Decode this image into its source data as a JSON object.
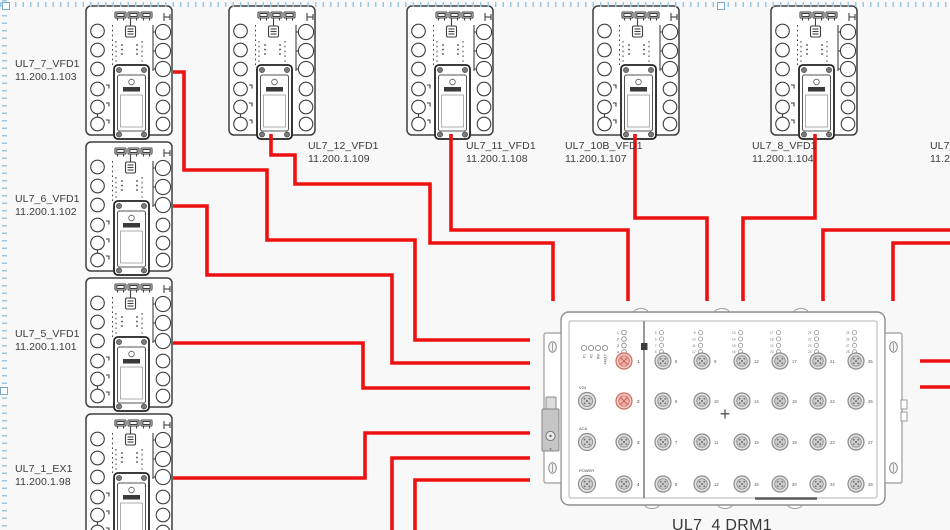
{
  "canvas": {
    "width": 950,
    "height": 530,
    "background": "#f8f8f8",
    "cable_color": "#ee1111",
    "outline_color": "#3f3f3f",
    "selection_color": "#9cc6e6"
  },
  "selection": {
    "handles": [
      {
        "x": 2,
        "y": 2
      },
      {
        "x": 717,
        "y": 2
      },
      {
        "x": 0,
        "y": 387
      }
    ]
  },
  "devices": [
    {
      "id": "UL7_7_VFD1",
      "label": "UL7_7_VFD1",
      "ip": "11.200.1.103",
      "x": 85,
      "y": 5,
      "label_x": 15,
      "label_y": 58
    },
    {
      "id": "UL7_6_VFD1",
      "label": "UL7_6_VFD1",
      "ip": "11.200.1.102",
      "x": 85,
      "y": 141,
      "label_x": 15,
      "label_y": 193
    },
    {
      "id": "UL7_5_VFD1",
      "label": "UL7_5_VFD1",
      "ip": "11.200.1.101",
      "x": 85,
      "y": 277,
      "label_x": 15,
      "label_y": 328
    },
    {
      "id": "UL7_1_EX1",
      "label": "UL7_1_EX1",
      "ip": "11.200.1.98",
      "x": 85,
      "y": 413,
      "label_x": 15,
      "label_y": 463
    },
    {
      "id": "UL7_12_VFD1",
      "label": "UL7_12_VFD1",
      "ip": "11.200.1.109",
      "x": 228,
      "y": 5,
      "label_x": 308,
      "label_y": 140
    },
    {
      "id": "UL7_11_VFD1",
      "label": "UL7_11_VFD1",
      "ip": "11.200.1.108",
      "x": 406,
      "y": 5,
      "label_x": 466,
      "label_y": 140
    },
    {
      "id": "UL7_10B_VFD1",
      "label": "UL7_10B_VFD1",
      "ip": "11.200.1.107",
      "x": 592,
      "y": 5,
      "label_x": 565,
      "label_y": 140
    },
    {
      "id": "UL7_8_VFD1",
      "label": "UL7_8_VFD1",
      "ip": "11.200.1.104",
      "x": 770,
      "y": 5,
      "label_x": 752,
      "label_y": 140
    },
    {
      "id": "UL7_offscreen",
      "label": "UL7_",
      "ip": "11.2",
      "x": null,
      "y": null,
      "label_x": 930,
      "label_y": 140
    }
  ],
  "cables": [
    {
      "name": "cable-UL7_7_VFD1",
      "points": [
        [
          173,
          72
        ],
        [
          184,
          72
        ],
        [
          184,
          170
        ],
        [
          267,
          170
        ],
        [
          267,
          240
        ],
        [
          415,
          240
        ],
        [
          415,
          340
        ],
        [
          530,
          340
        ]
      ]
    },
    {
      "name": "cable-UL7_6_VFD1",
      "points": [
        [
          173,
          206
        ],
        [
          207,
          206
        ],
        [
          207,
          275
        ],
        [
          392,
          275
        ],
        [
          392,
          363
        ],
        [
          530,
          363
        ]
      ]
    },
    {
      "name": "cable-UL7_5_VFD1",
      "points": [
        [
          173,
          343
        ],
        [
          363,
          343
        ],
        [
          363,
          388
        ],
        [
          530,
          388
        ]
      ]
    },
    {
      "name": "cable-UL7_1_EX1",
      "points": [
        [
          173,
          478
        ],
        [
          365,
          478
        ],
        [
          365,
          433
        ],
        [
          530,
          433
        ]
      ]
    },
    {
      "name": "cable-from-bottom-1",
      "points": [
        [
          392,
          532
        ],
        [
          392,
          458
        ],
        [
          530,
          458
        ]
      ]
    },
    {
      "name": "cable-from-bottom-2",
      "points": [
        [
          415,
          532
        ],
        [
          415,
          480
        ],
        [
          530,
          480
        ]
      ]
    },
    {
      "name": "cable-UL7_12_VFD1",
      "points": [
        [
          271,
          134
        ],
        [
          271,
          155
        ],
        [
          295,
          155
        ],
        [
          295,
          184
        ],
        [
          430,
          184
        ],
        [
          430,
          243
        ],
        [
          553,
          243
        ],
        [
          553,
          301
        ]
      ]
    },
    {
      "name": "cable-UL7_11_VFD1",
      "points": [
        [
          451,
          134
        ],
        [
          451,
          230
        ],
        [
          628,
          230
        ],
        [
          628,
          301
        ]
      ]
    },
    {
      "name": "cable-UL7_10B_VFD1",
      "points": [
        [
          635,
          134
        ],
        [
          635,
          218
        ],
        [
          707,
          218
        ],
        [
          707,
          301
        ]
      ]
    },
    {
      "name": "cable-UL7_8_VFD1",
      "points": [
        [
          815,
          134
        ],
        [
          815,
          218
        ],
        [
          743,
          218
        ],
        [
          743,
          301
        ]
      ]
    },
    {
      "name": "cable-from-right-1",
      "points": [
        [
          952,
          230
        ],
        [
          823,
          230
        ],
        [
          823,
          301
        ]
      ]
    },
    {
      "name": "cable-from-right-2",
      "points": [
        [
          952,
          243
        ],
        [
          893,
          243
        ],
        [
          893,
          301
        ]
      ]
    },
    {
      "name": "cable-stub-right-1",
      "points": [
        [
          920,
          361
        ],
        [
          952,
          361
        ]
      ]
    },
    {
      "name": "cable-stub-right-2",
      "points": [
        [
          920,
          387
        ],
        [
          952,
          387
        ]
      ]
    }
  ],
  "drm": {
    "x": 540,
    "y": 296,
    "title": "UL7_4 DRM1",
    "status_leds": [
      "P1",
      "P2",
      "RM",
      "FAULT"
    ],
    "left_led_numbers": [
      "1",
      "2",
      "3",
      "4"
    ],
    "left_ports": [
      {
        "n": "1",
        "active": true
      },
      {
        "n": "2",
        "active": true
      },
      {
        "n": "3",
        "active": false
      },
      {
        "n": "4",
        "active": false
      }
    ],
    "aux_ports": [
      {
        "label": "V24"
      },
      {
        "label": "ACA"
      },
      {
        "label": "POWER"
      }
    ],
    "right_port_columns": [
      [
        "5",
        "6",
        "7",
        "8"
      ],
      [
        "9",
        "10",
        "11",
        "12"
      ],
      [
        "13",
        "14",
        "15",
        "16"
      ],
      [
        "17",
        "18",
        "19",
        "20"
      ],
      [
        "21",
        "22",
        "23",
        "24"
      ],
      [
        "25",
        "26",
        "27",
        "28"
      ]
    ],
    "center_mark": "+",
    "active_port_color": "#f7cbc6",
    "active_port_stroke": "#c96a5e",
    "port_color": "#e2e2e2",
    "port_stroke": "#8b8b8b"
  }
}
